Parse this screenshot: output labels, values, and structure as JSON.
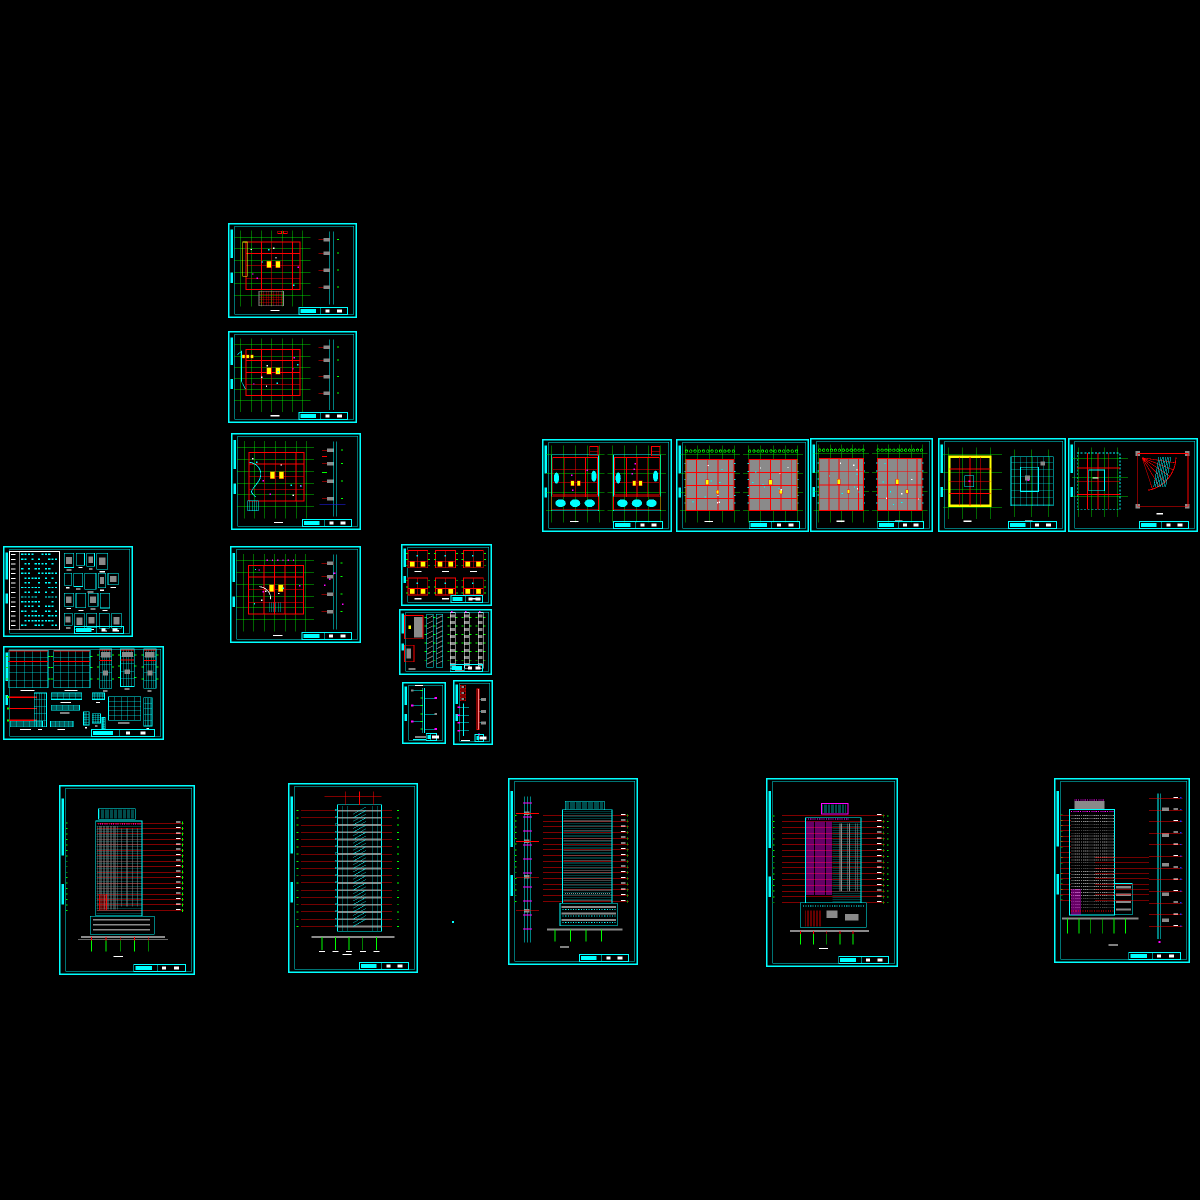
{
  "meta": {
    "canvas": {
      "width": 1200,
      "height": 1200,
      "background": "#000000"
    },
    "application": "cad-model-space-export",
    "sheet_count": 20
  },
  "palette": {
    "background": "#000000",
    "frame": "#00ffff",
    "walls": "#ff0000",
    "axes": "#00ff00",
    "fills": "#ffff00",
    "accent": "#ff00ff",
    "detail_gray": "#8a8a8a",
    "text": "#ffffff",
    "blue": "#2222ff"
  },
  "stray_mark": {
    "x": 452,
    "y": 921,
    "w": 2,
    "h": 2,
    "color": "#00ffff"
  },
  "sheets": [
    {
      "id": "plan-01",
      "name": "floor-plan-sheet-1",
      "kind": "floor-plan",
      "bbox": [
        228,
        223,
        129,
        95
      ],
      "params": {
        "variant": "hatch",
        "axes_v": 7,
        "axes_h": 6
      }
    },
    {
      "id": "plan-02",
      "name": "floor-plan-sheet-2",
      "kind": "floor-plan",
      "bbox": [
        228,
        331,
        129,
        92
      ],
      "params": {
        "variant": "plain",
        "axes_v": 7,
        "axes_h": 6
      }
    },
    {
      "id": "plan-03",
      "name": "floor-plan-sheet-3",
      "kind": "floor-plan",
      "bbox": [
        231,
        433,
        130,
        97
      ],
      "params": {
        "variant": "arc",
        "axes_v": 7,
        "axes_h": 6
      }
    },
    {
      "id": "plan-04",
      "name": "floor-plan-sheet-4",
      "kind": "floor-plan",
      "bbox": [
        230,
        546,
        131,
        97
      ],
      "params": {
        "variant": "arc2",
        "axes_v": 7,
        "axes_h": 6
      }
    },
    {
      "id": "schedule",
      "name": "door-window-schedule",
      "kind": "schedule",
      "bbox": [
        3,
        546,
        130,
        91
      ],
      "params": {
        "rows": 16
      }
    },
    {
      "id": "window-details",
      "name": "window-detail-sheet",
      "kind": "window-schedule",
      "bbox": [
        3,
        646,
        161,
        94
      ],
      "params": {}
    },
    {
      "id": "detail-grid",
      "name": "plan-detail-grid",
      "kind": "detail-six",
      "bbox": [
        401,
        544,
        91,
        62
      ],
      "params": {
        "cols": 3,
        "rows": 2
      }
    },
    {
      "id": "stair-details",
      "name": "stair-detail-sheet",
      "kind": "stair-details",
      "bbox": [
        399,
        609,
        93,
        66
      ],
      "params": {}
    },
    {
      "id": "strip-detail-1",
      "name": "section-detail-1",
      "kind": "strip-detail",
      "bbox": [
        402,
        682,
        44,
        62
      ],
      "params": {}
    },
    {
      "id": "strip-detail-2",
      "name": "section-detail-2",
      "kind": "strip-detail2",
      "bbox": [
        453,
        680,
        40,
        65
      ],
      "params": {}
    },
    {
      "id": "plan-pair-1",
      "name": "paired-floor-plans-1",
      "kind": "plan-pair",
      "bbox": [
        542,
        439,
        130,
        93
      ],
      "params": {
        "style": "open"
      }
    },
    {
      "id": "plan-pair-2",
      "name": "paired-floor-plans-2",
      "kind": "plan-pair",
      "bbox": [
        676,
        439,
        133,
        93
      ],
      "params": {
        "style": "gray"
      }
    },
    {
      "id": "plan-pair-3",
      "name": "paired-floor-plans-3",
      "kind": "plan-pair",
      "bbox": [
        810,
        438,
        123,
        94
      ],
      "params": {
        "style": "gray"
      }
    },
    {
      "id": "roof-plans",
      "name": "roof-plan-pair",
      "kind": "roof-pair",
      "bbox": [
        938,
        438,
        128,
        94
      ],
      "params": {}
    },
    {
      "id": "plan-fan",
      "name": "plan-and-fan-detail",
      "kind": "plan-fan",
      "bbox": [
        1068,
        438,
        130,
        94
      ],
      "params": {}
    },
    {
      "id": "elev-1",
      "name": "building-elevation-1",
      "kind": "elevation",
      "bbox": [
        59,
        785,
        136,
        190
      ],
      "params": {
        "variant": "stripes",
        "levels": 17
      }
    },
    {
      "id": "section-1",
      "name": "building-section",
      "kind": "building-section",
      "bbox": [
        288,
        783,
        130,
        190
      ],
      "params": {
        "levels": 17
      }
    },
    {
      "id": "elev-2",
      "name": "building-elevation-2",
      "kind": "elevation",
      "bbox": [
        508,
        778,
        130,
        187
      ],
      "params": {
        "variant": "hatch",
        "levels": 16
      }
    },
    {
      "id": "elev-3",
      "name": "building-elevation-3",
      "kind": "elevation",
      "bbox": [
        766,
        778,
        132,
        189
      ],
      "params": {
        "variant": "magenta",
        "levels": 16
      }
    },
    {
      "id": "elev-4",
      "name": "building-elevation-4",
      "kind": "elevation",
      "bbox": [
        1054,
        778,
        136,
        185
      ],
      "params": {
        "variant": "dots",
        "levels": 17
      }
    }
  ]
}
